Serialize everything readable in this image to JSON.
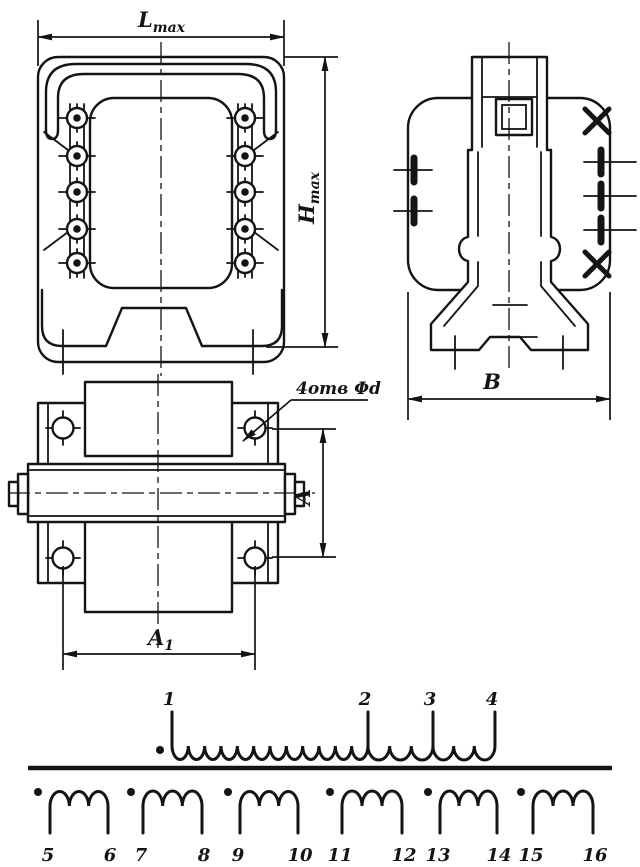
{
  "labels": {
    "lmax_main": "L",
    "lmax_sub": "max",
    "hmax_main": "H",
    "hmax_sub": "max",
    "b": "B",
    "a": "A",
    "a1_main": "A",
    "a1_sub": "1",
    "holes_note": "4отв Φd"
  },
  "schematic": {
    "primary": {
      "terminals": [
        "1",
        "2",
        "3",
        "4"
      ],
      "section_turns": [
        12,
        3,
        3
      ],
      "polarity_dot": true
    },
    "secondaries": [
      {
        "start_terminal": "5",
        "end_terminal": "6",
        "turns": 3,
        "polarity_dot": true
      },
      {
        "start_terminal": "7",
        "end_terminal": "8",
        "turns": 3,
        "polarity_dot": true
      },
      {
        "start_terminal": "9",
        "end_terminal": "10",
        "turns": 3,
        "polarity_dot": true
      },
      {
        "start_terminal": "11",
        "end_terminal": "12",
        "turns": 3,
        "polarity_dot": true
      },
      {
        "start_terminal": "13",
        "end_terminal": "14",
        "turns": 3,
        "polarity_dot": true
      },
      {
        "start_terminal": "15",
        "end_terminal": "16",
        "turns": 3,
        "polarity_dot": true
      }
    ],
    "front_view_terminals_per_side": 5,
    "mounting_holes": 4
  },
  "style": {
    "ink": "#141414",
    "paper": "#ffffff"
  }
}
